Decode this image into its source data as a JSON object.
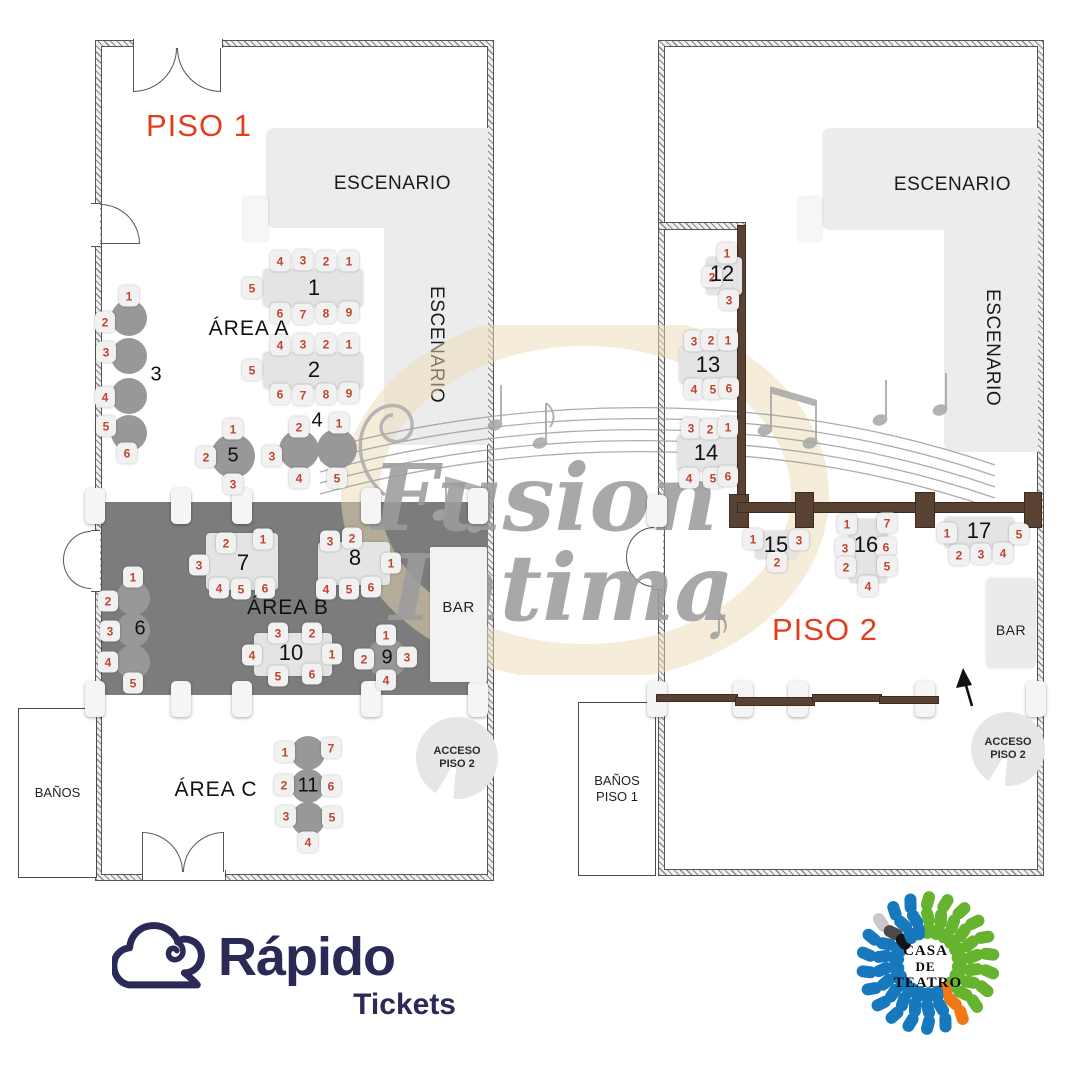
{
  "floors": [
    {
      "id": "p1",
      "label": "PISO 1",
      "stage_label": "ESCENARIO",
      "areas": [
        {
          "label": "ÁREA A"
        },
        {
          "label": "ÁREA B"
        },
        {
          "label": "ÁREA C"
        }
      ],
      "bar_label": "BAR",
      "restroom_label": "BAÑOS",
      "access_line1": "ACCESO",
      "access_line2": "PISO 2",
      "tables": [
        {
          "id": "t1",
          "number": "1",
          "seats": [
            "4",
            "3",
            "2",
            "1",
            "5",
            "6",
            "7",
            "8",
            "9"
          ]
        },
        {
          "id": "t2",
          "number": "2",
          "seats": [
            "4",
            "3",
            "2",
            "1",
            "5",
            "6",
            "7",
            "8",
            "9"
          ]
        },
        {
          "id": "t3",
          "number": "3",
          "seats": [
            "1",
            "2",
            "3",
            "4",
            "5",
            "6"
          ]
        },
        {
          "id": "t4",
          "number": "4",
          "seats": [
            "2",
            "1",
            "3",
            "4",
            "5"
          ]
        },
        {
          "id": "t5",
          "number": "5",
          "seats": [
            "1",
            "2",
            "3"
          ]
        },
        {
          "id": "t6",
          "number": "6",
          "seats": [
            "1",
            "2",
            "3",
            "4",
            "5"
          ]
        },
        {
          "id": "t7",
          "number": "7",
          "seats": [
            "2",
            "1",
            "3",
            "4",
            "5",
            "6"
          ]
        },
        {
          "id": "t8",
          "number": "8",
          "seats": [
            "3",
            "2",
            "1",
            "4",
            "5",
            "6"
          ]
        },
        {
          "id": "t9",
          "number": "9",
          "seats": [
            "1",
            "2",
            "3",
            "4"
          ]
        },
        {
          "id": "t10",
          "number": "10",
          "seats": [
            "3",
            "2",
            "4",
            "1",
            "5",
            "6"
          ]
        },
        {
          "id": "t11",
          "number": "11",
          "seats": [
            "1",
            "7",
            "2",
            "6",
            "3",
            "5",
            "4"
          ]
        }
      ]
    },
    {
      "id": "p2",
      "label": "PISO 2",
      "stage_label": "ESCENARIO",
      "bar_label": "BAR",
      "restroom_line1": "BAÑOS",
      "restroom_line2": "PISO 1",
      "access_line1": "ACCESO",
      "access_line2": "PISO 2",
      "tables": [
        {
          "id": "t12",
          "number": "12",
          "seats": [
            "1",
            "2",
            "3"
          ]
        },
        {
          "id": "t13",
          "number": "13",
          "seats": [
            "3",
            "2",
            "1",
            "4",
            "5",
            "6"
          ]
        },
        {
          "id": "t14",
          "number": "14",
          "seats": [
            "3",
            "2",
            "1",
            "4",
            "5",
            "6"
          ]
        },
        {
          "id": "t15",
          "number": "15",
          "seats": [
            "1",
            "3",
            "2"
          ]
        },
        {
          "id": "t16",
          "number": "16",
          "seats": [
            "1",
            "7",
            "3",
            "6",
            "2",
            "5",
            "4"
          ]
        },
        {
          "id": "t17",
          "number": "17",
          "seats": [
            "1",
            "5",
            "2",
            "3",
            "4"
          ]
        }
      ]
    }
  ],
  "watermark": {
    "line1": "Fusion",
    "line2": "Intima",
    "note": "♪"
  },
  "branding": {
    "rapido": {
      "title": "Rápido",
      "subtitle": "Tickets"
    },
    "casa": {
      "line1": "CASA",
      "line2": "DE",
      "line3": "TEATRO"
    }
  },
  "colors": {
    "accent_red": "#E23E1D",
    "seat_number_red": "#C0452F",
    "navy": "#2B2956",
    "railing_brown": "#5A4232",
    "casa_blue": "#1878BE",
    "casa_green": "#65B32E",
    "casa_orange": "#F07818",
    "casa_black": "#1A1A1A"
  }
}
